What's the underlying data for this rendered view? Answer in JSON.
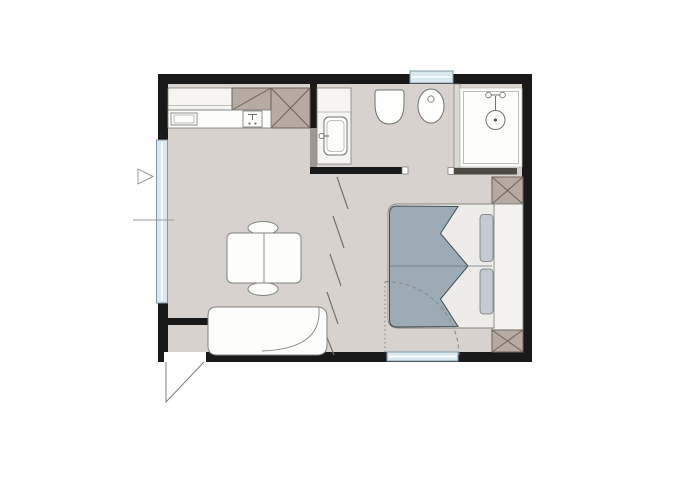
{
  "canvas": {
    "width": 700,
    "height": 500,
    "kind": "architectural floor plan, studio apartment, no text labels"
  },
  "colors": {
    "bg": "#ffffff",
    "wall": "#191919",
    "wall-light": "#9d9992",
    "floor": "#d7d2cd",
    "taupe": "#b5aba3",
    "taupe-border": "#6e6359",
    "furn": "#fdfdfb",
    "outline": "#82827c",
    "fixture": "#fefefc",
    "fixture-line": "#72726c",
    "inner-line": "#aeaea8",
    "glass": "#dbe7ee",
    "glass-frame": "#8099a6",
    "mark": "#73736d",
    "duvet": "#9dacb4",
    "duvet-edge": "#434e54",
    "sheet": "#edece8",
    "pillow": "#c3cbd0",
    "pillow-edge": "#6f787d",
    "headboard": "#f3f2ef",
    "cabinet": "#f6f5f2",
    "shower-bar": "#4b4b44"
  },
  "inventory": {
    "rooms_depicted": [
      "living-dining area",
      "kitchenette",
      "bathroom",
      "shower cell",
      "sleeping area",
      "entry vestibule"
    ],
    "fixtures": [
      "kitchen counter with sink and tap unit",
      "corner cabinet",
      "three crossed service columns",
      "washbasin vanity with tap",
      "wall-hung toilet",
      "bidet",
      "shower with head and valve",
      "double bed with folded duvet and two pillows",
      "headboard wardrobe",
      "dining table with two chairs",
      "corner sofa"
    ],
    "openings": [
      "left facade window",
      "top facade window",
      "bottom facade window",
      "entrance door swinging outward",
      "bathroom passage",
      "shower sliding screen",
      "bedroom pivot door shown dashed",
      "folding partition marks"
    ]
  }
}
